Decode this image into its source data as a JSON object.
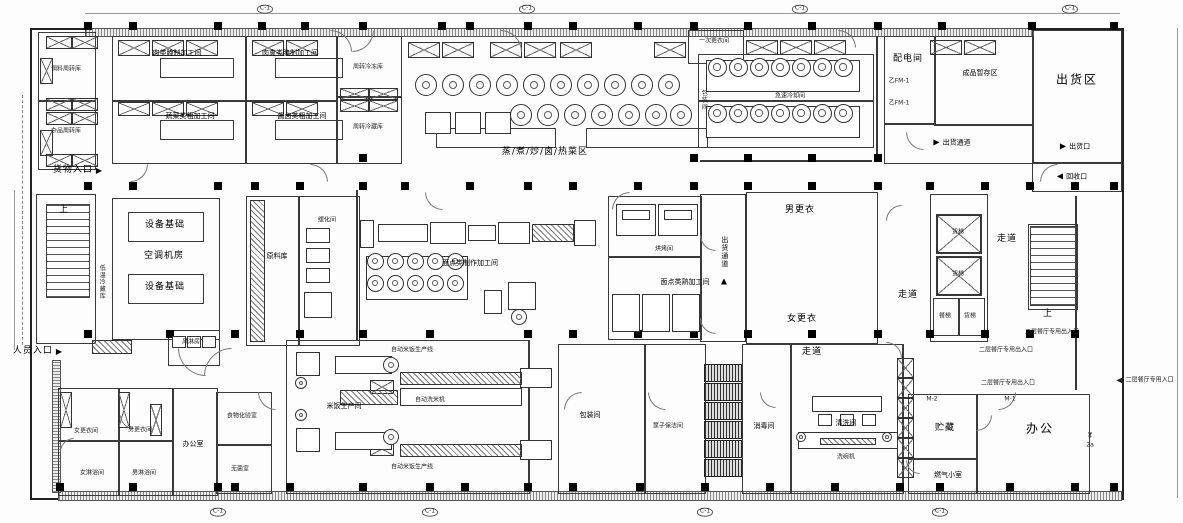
{
  "colors": {
    "line": "#333333",
    "wall": "#000000",
    "paper": "#fdfdfd"
  },
  "icons": {
    "arrow_right": "▶",
    "arrow_left": "◀",
    "arrow_up": "▲"
  },
  "grid": {
    "bubble_label": "C-1"
  },
  "labels": {
    "goods_entrance": "货物入口",
    "staff_entrance": "人员入口",
    "store_tl_1": "调料周转库",
    "store_tl_2": "杂品周转库",
    "meat_proc_1": "肉类腌制加工间",
    "meat_proc_2": "肉禽类腌制加工间",
    "veg_proc": "蔬菜类粗加工间",
    "sauce_proc": "酱卤类粗加工间",
    "turnover_freezer": "周转冷冻库",
    "turnover_cold": "周转冷藏库",
    "hot_area": "蒸/煮/炒/卤/热菜区",
    "first_changing": "一次更衣间",
    "quick_cooling": "急速冷却间",
    "packing": "包装间",
    "power_room": "配电间",
    "door_fm": "乙FM-1",
    "finished_storage": "成品暂存区",
    "shipping_area": "出货区",
    "shipping_corridor": "出货通道",
    "shipping_port": "出货口",
    "recycle_port": "回收口",
    "lt_cold": "低温冷藏库",
    "equip_base": "设备基础",
    "ac_room": "空调机房",
    "up": "上",
    "air_shower": "风淋房",
    "raw_store": "原料库",
    "thaw_room": "缓化间",
    "noodle_make": "面点类制作加工间",
    "bake_room": "烘烤间",
    "noodle_cooked": "面点类熟加工间",
    "men_change": "男更衣",
    "women_change": "女更衣",
    "corridor": "走道",
    "freight_elev": "货梯",
    "food_elev": "餐梯",
    "women_change_room": "女更衣间",
    "men_change_room": "男更衣间",
    "women_shower": "女淋浴间",
    "men_shower": "男淋浴间",
    "office_room": "办公室",
    "food_lab": "食物化验室",
    "sterile_room": "无菌室",
    "rice_room": "米饭生产间",
    "rice_line": "自动米饭生产线",
    "rice_washer": "自动洗米机",
    "basket_clean": "筐子保洁间",
    "disinfect": "消毒间",
    "wash_room": "清洗间",
    "dishwasher": "洗碗机",
    "storage": "贮藏",
    "gas_room": "燃气小室",
    "office_area": "办公",
    "door_m1": "M-1",
    "door_m2": "M-2",
    "upper_note": "二层餐厅专用出入口",
    "upper_entry": "二层餐厅专用入口",
    "stamp_top": "4",
    "stamp_bottom": "2a"
  }
}
